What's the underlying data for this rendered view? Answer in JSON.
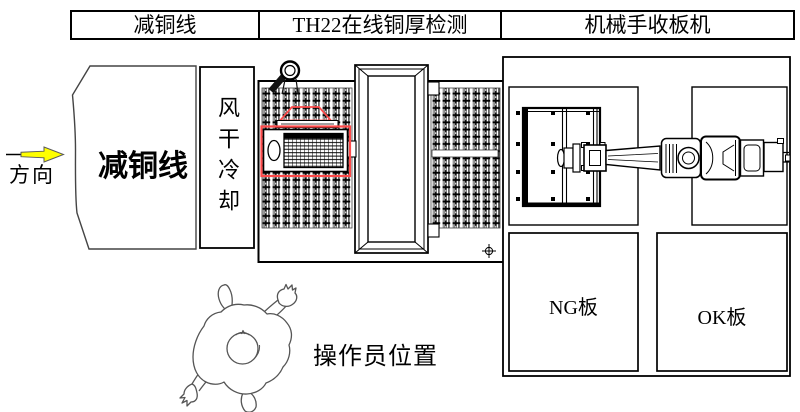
{
  "header": {
    "cells": [
      {
        "label": "减铜线"
      },
      {
        "label": "TH22在线铜厚检测"
      },
      {
        "label": "机械手收板机"
      }
    ]
  },
  "flow": {
    "direction_label": "方向"
  },
  "sections": {
    "copper_line_label": "减铜线",
    "air_dry_label": "风干冷却",
    "ng_label": "NG板",
    "ok_label": "OK板",
    "operator_label": "操作员位置"
  },
  "colors": {
    "highlight_red": "#ff4a4a",
    "arrow_yellow": "#ffff00"
  }
}
